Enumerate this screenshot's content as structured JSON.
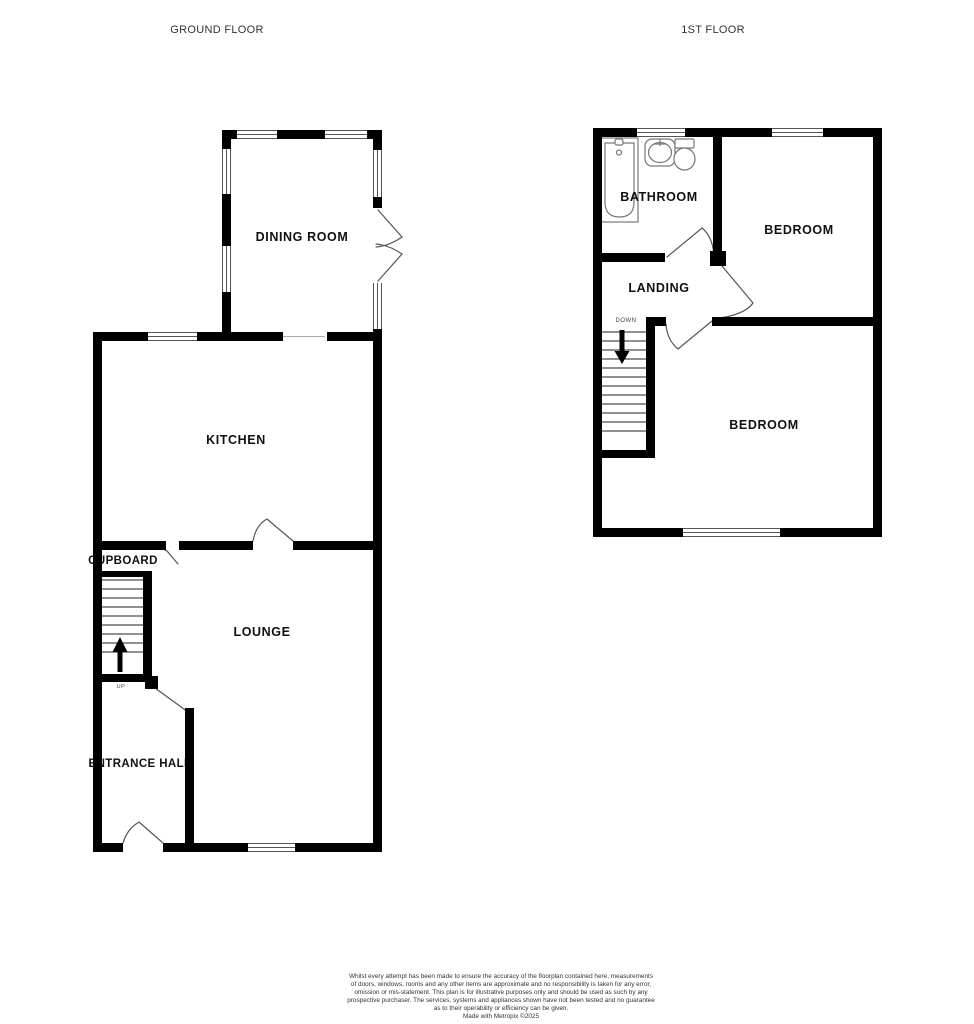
{
  "titles": {
    "ground_floor": "GROUND FLOOR",
    "first_floor": "1ST FLOOR"
  },
  "ground_floor": {
    "dining_room": "DINING ROOM",
    "kitchen": "KITCHEN",
    "lounge": "LOUNGE",
    "cupboard": "CUPBOARD",
    "entrance_hall": "ENTRANCE HALL",
    "stairs_label": "UP"
  },
  "first_floor": {
    "bathroom": "BATHROOM",
    "bedroom_front": "BEDROOM",
    "landing": "LANDING",
    "bedroom_rear": "BEDROOM",
    "stairs_label": "DOWN"
  },
  "footer": {
    "lines": [
      "Whilst every attempt has been made to ensure the accuracy of the floorplan contained here, measurements",
      "of doors, windows, rooms and any other items are approximate and no responsibility is taken for any error,",
      "omission or mis-statement. This plan is for illustrative purposes only and should be used as such by any",
      "prospective purchaser. The services, systems and appliances shown have not been tested and no guarantee",
      "as to their operability or efficiency can be given.",
      "Made with Metropix ©2025"
    ]
  },
  "colors": {
    "background": "#ffffff",
    "wall": "#000000",
    "window_line": "#555555",
    "door_line": "#555555",
    "fixture_line": "#777777",
    "room_label": "#111111",
    "title_text": "#333333",
    "footer_text": "#333333"
  }
}
